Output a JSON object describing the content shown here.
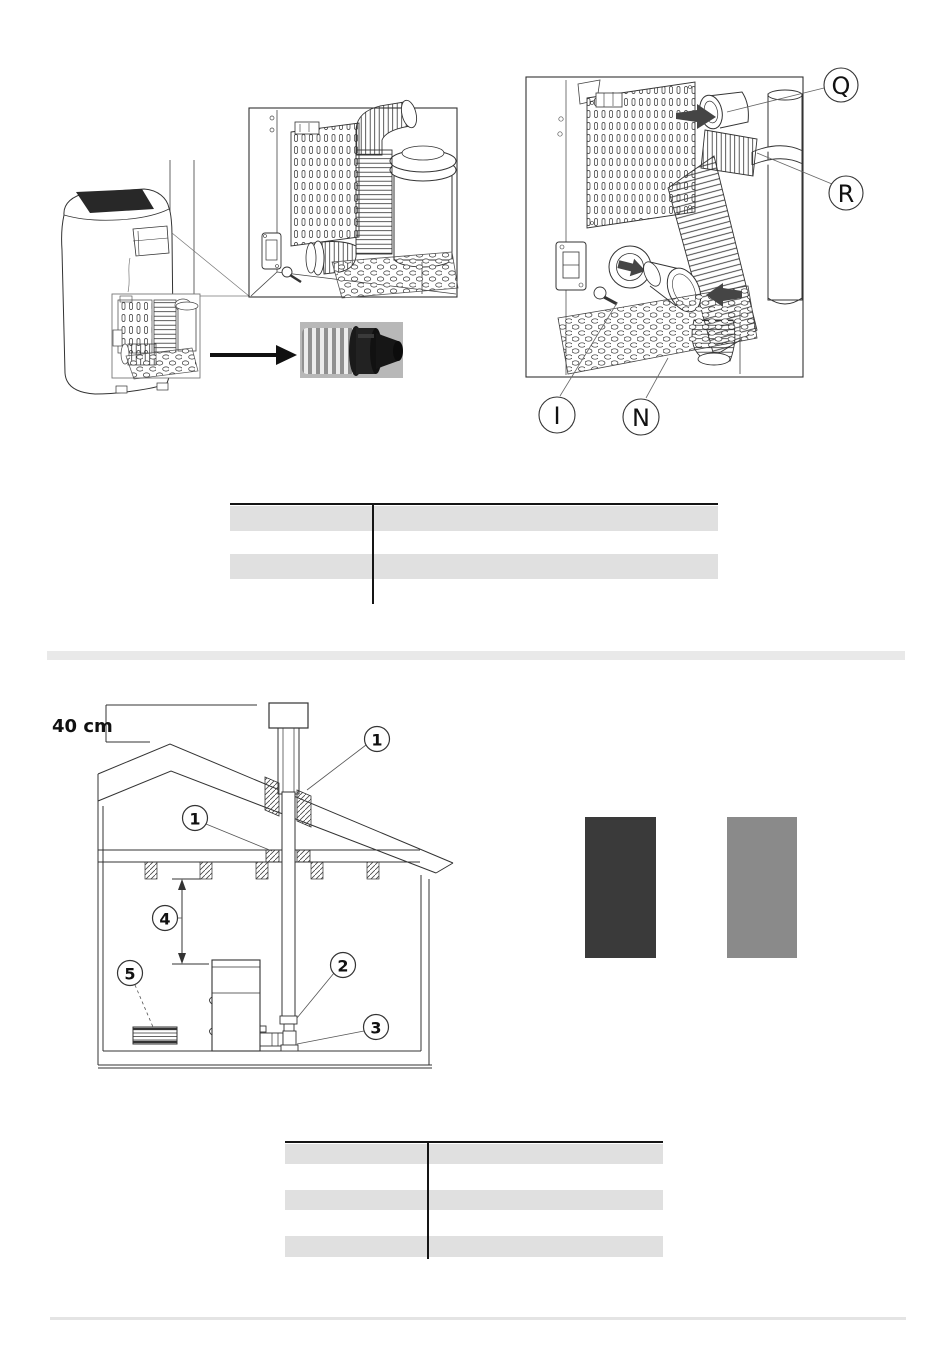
{
  "rear_view": {
    "callouts": {
      "q": "Q",
      "r": "R",
      "i": "I",
      "n": "N"
    }
  },
  "house": {
    "dimension_label": "40 cm",
    "callouts": {
      "roof": "1",
      "ceiling": "1",
      "flue_pipe": "2",
      "tee_fitting": "3",
      "min_distance": "4",
      "air_grille": "5"
    }
  },
  "swatches": {
    "dark": "#3a3a3a",
    "gray": "#8a8a8a"
  },
  "colors": {
    "table_row": "#e0e0e0",
    "divider_bar": "#e9e9e9",
    "footer_rule": "#e4e4e4"
  }
}
